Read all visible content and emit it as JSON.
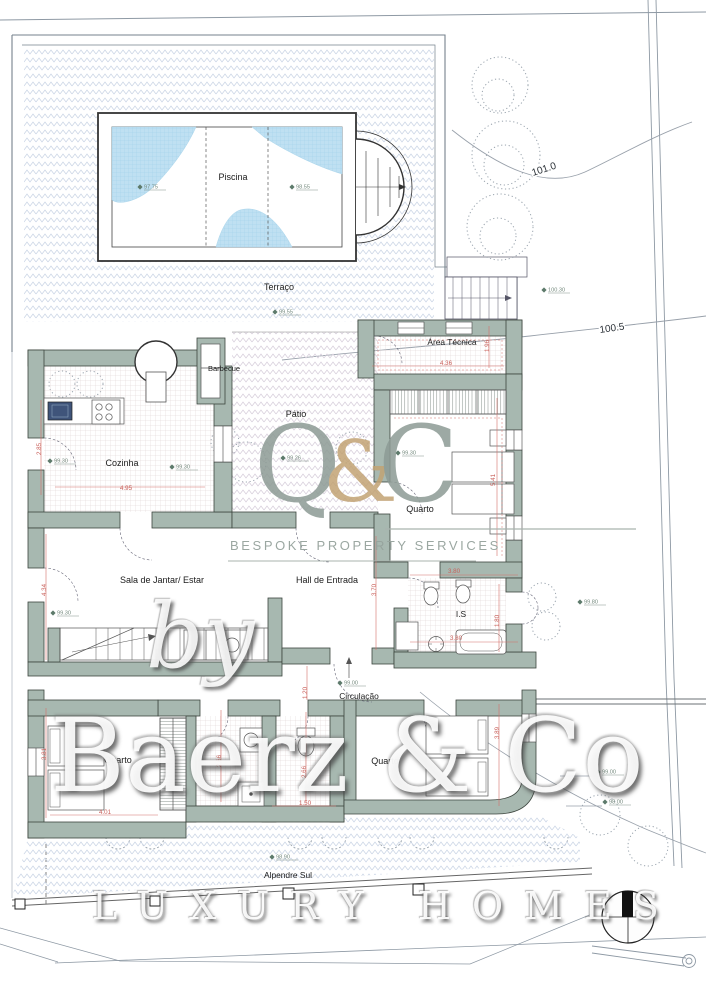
{
  "plan": {
    "rooms": {
      "piscina": "Piscina",
      "terraco": "Terraço",
      "barbecue": "Barbecue",
      "area_tecnica": "Área Técnica",
      "patio": "Pátio",
      "cozinha": "Cozinha",
      "quarto_este": "Quarto",
      "sala": "Sala de Jantar/ Estar",
      "hall": "Hall de Entrada",
      "is": "I.S",
      "circulacao": "Circulação",
      "quarto_oeste": "Quarto",
      "quarto_sul": "Quarto",
      "alpendre": "Alpendre Sul"
    },
    "contours": {
      "c_upper": "101.0",
      "c_lower": "100.5"
    },
    "levels": {
      "pool_left": "97.75",
      "pool_right": "98.55",
      "terrace": "99.55",
      "stair": "100.30",
      "cozinha_a": "99.30",
      "cozinha_b": "99.30",
      "patio": "99.26",
      "quarto_este": "99.30",
      "sala": "99.30",
      "circulacao": "99.00",
      "east": "99.80",
      "alpendre": "98.90",
      "slope_a": "99.00",
      "slope_b": "98.00"
    },
    "dimensions": {
      "cozinha_w": "4.95",
      "cozinha_h": "2.85",
      "area_tecnica_w": "4.36",
      "area_tecnica_h": "1.96",
      "quarto_este_h": "5.41",
      "hall_h": "3.70",
      "sala_h": "4.34",
      "is_w": "3.80",
      "is_w2": "3.80",
      "is_h": "1.80",
      "corredor": "1.20",
      "bath_a": "2.66",
      "bath_b": "2.66",
      "bath_w": "1.50",
      "quarto_oeste_h": "3.81",
      "quarto_oeste_w": "4.01",
      "quarto_sul_h": "3.89"
    }
  },
  "watermark": {
    "monogram": {
      "q": "Q",
      "amp": "&",
      "c": "C"
    },
    "tagline": "BESPOKE PROPERTY SERVICES",
    "byline": "by",
    "brand": "Baerz & Co",
    "brand_tagline": "LUXURY HOMES"
  },
  "colors": {
    "wall": "#a7b8b0",
    "pool_water": "#bfe0f2",
    "dimension_red": "#c9605a",
    "hatch": "#c9d4e4",
    "contour_gray": "#98a0aa",
    "monogram_gray": "#8d9b95",
    "monogram_gold": "#c2a374"
  }
}
